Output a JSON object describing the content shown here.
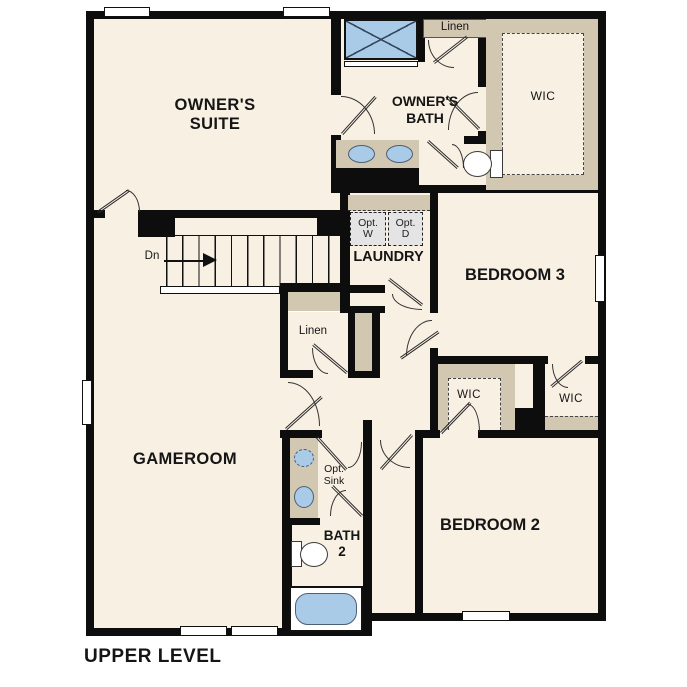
{
  "title": "UPPER LEVEL",
  "colors": {
    "floor": "#f8f0e3",
    "wall": "#0d0d0d",
    "tan": "#d2c8b2",
    "blue": "#a9cbe8",
    "appliance": "#e4e4e4"
  },
  "labels": {
    "owners_suite": "OWNER'S\nSUITE",
    "owners_bath": "OWNER'S\nBATH",
    "linen_top": "Linen",
    "wic_owners": "WIC",
    "laundry": "LAUNDRY",
    "opt_washer": "Opt.\nW",
    "opt_dryer": "Opt.\nD",
    "bedroom3": "BEDROOM 3",
    "linen_hall": "Linen",
    "gameroom": "GAMEROOM",
    "wic_bedroom2": "WIC",
    "wic_bedroom3": "WIC",
    "opt_sink": "Opt.\nSink",
    "bath2": "BATH\n2",
    "bedroom2": "BEDROOM 2",
    "stairs_down": "Dn"
  }
}
